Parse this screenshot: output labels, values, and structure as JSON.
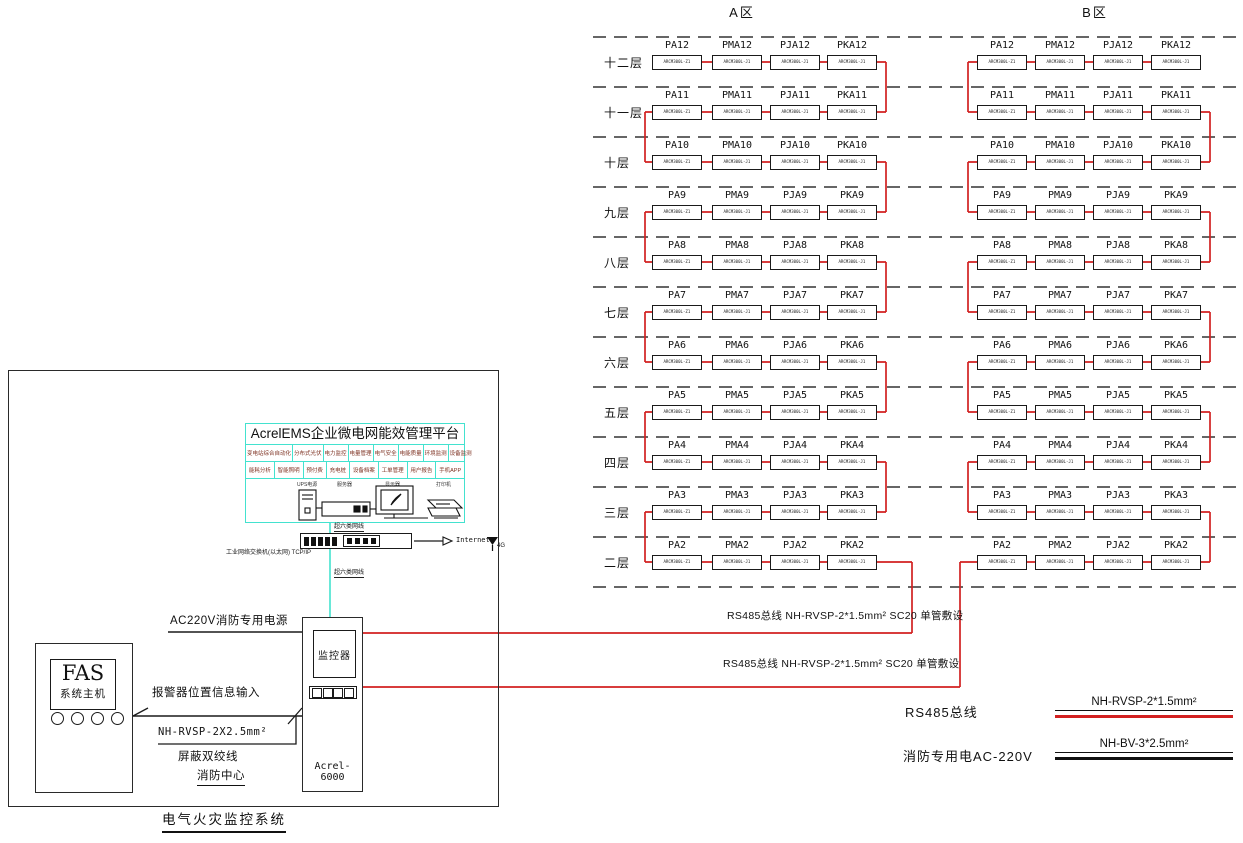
{
  "zone_a": {
    "title": "A区"
  },
  "zone_b": {
    "title": "B区"
  },
  "floors": [
    {
      "num": "12",
      "label": "十二层"
    },
    {
      "num": "11",
      "label": "十一层"
    },
    {
      "num": "10",
      "label": "十层"
    },
    {
      "num": "9",
      "label": "九层"
    },
    {
      "num": "8",
      "label": "八层"
    },
    {
      "num": "7",
      "label": "七层"
    },
    {
      "num": "6",
      "label": "六层"
    },
    {
      "num": "5",
      "label": "五层"
    },
    {
      "num": "4",
      "label": "四层"
    },
    {
      "num": "3",
      "label": "三层"
    },
    {
      "num": "2",
      "label": "二层"
    }
  ],
  "device_prefixes": [
    "PA",
    "PMA",
    "PJA",
    "PKA"
  ],
  "detector_models": [
    "ARCM300L-Z1",
    "ARCM300L-J1",
    "ARCM300L-J1",
    "ARCM300L-J1"
  ],
  "bus_labels": {
    "a": "RS485总线 NH-RVSP-2*1.5mm² SC20 单管敷设",
    "b": "RS485总线 NH-RVSP-2*1.5mm² SC20 单管敷设"
  },
  "legend": {
    "rows": [
      {
        "label": "RS485总线",
        "wire_label": "NH-RVSP-2*1.5mm²",
        "color": "#d22020"
      },
      {
        "label": "消防专用电AC-220V",
        "wire_label": "NH-BV-3*2.5mm²",
        "color": "#111111"
      }
    ]
  },
  "platform": {
    "title": "AcrelEMS企业微电网能效管理平台",
    "features_row1": [
      "变电站综合自动化",
      "分布式光伏",
      "电力监控",
      "电量管理",
      "电气安全",
      "电能质量",
      "环境监测",
      "设备监测"
    ],
    "features_row2": [
      "能耗分析",
      "智能照明",
      "预付费",
      "充电桩",
      "设备档案",
      "工单管理",
      "用户报告",
      "手机APP"
    ],
    "devices": [
      "UPS电源",
      "服务器",
      "显示器",
      "打印机"
    ]
  },
  "network": {
    "cable_top": "超六类网线",
    "cable_bottom": "超六类网线",
    "switch_label": "工业网络交换机(以太网) TCP/IP",
    "internet": "Internet",
    "wireless": "4G"
  },
  "cabinet": {
    "screen": "监控器",
    "model": "Acrel-6000"
  },
  "fas": {
    "title": "FAS",
    "subtitle": "系统主机"
  },
  "annotations": {
    "power": "AC220V消防专用电源",
    "alarm": "报警器位置信息输入",
    "cable_spec": "NH-RVSP-2X2.5mm²",
    "shielded": "屏蔽双绞线",
    "fire_center": "消防中心",
    "system_title": "电气火灾监控系统"
  },
  "colors": {
    "bus": "#d22020",
    "network_cable": "#43e2cf",
    "line": "#1a1a1a",
    "dashed": "#333333"
  }
}
